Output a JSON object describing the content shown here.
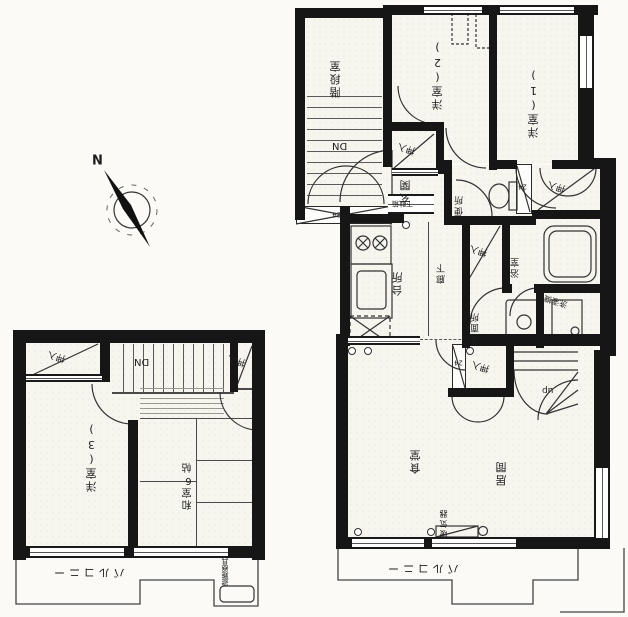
{
  "document": {
    "kind": "scanned floor plan, rotated 180°",
    "floors": [
      "1F",
      "2F"
    ]
  },
  "colors": {
    "wall": "#161616",
    "ink": "#333333",
    "paper": "#f6f5ee"
  },
  "labels": {
    "stair_hall": "階段室",
    "western_room_1": "洋室(1)",
    "western_room_2": "洋室(2)",
    "western_room_3": "洋室(3)",
    "japanese_room": "和室6帖",
    "closet": "押入",
    "storage": "物入",
    "entrance": "玄関",
    "shoe_cabinet": "下駄箱",
    "toilet": "便所",
    "kitchen": "台所",
    "hallway": "廊下",
    "bath": "浴室",
    "washroom": "洗面所",
    "washing_machine": "洗濯機",
    "dining": "食堂",
    "living": "居間",
    "heater": "暖気器",
    "balcony": "バルコニー",
    "evacuation": "避難器具",
    "down": "DN",
    "up": "up",
    "north": "N",
    "duct": "24"
  }
}
